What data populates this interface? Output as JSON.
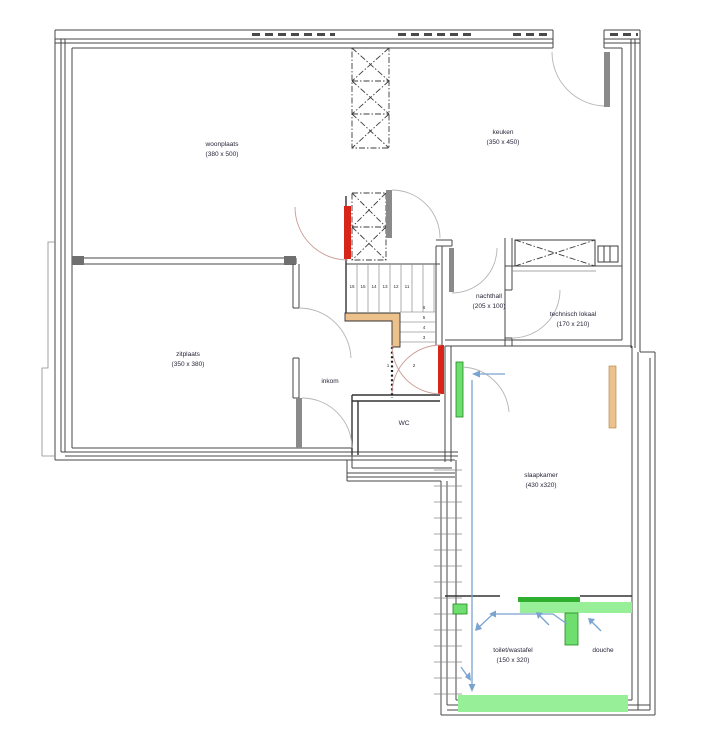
{
  "plan": {
    "title": "floor plan",
    "rooms": {
      "woonplaats": {
        "name": "woonplaats",
        "dim": "(380 x 500)"
      },
      "keuken": {
        "name": "keuken",
        "dim": "(350 x 450)"
      },
      "zitplaats": {
        "name": "zitplaats",
        "dim": "(350 x 380)"
      },
      "inkom": {
        "name": "inkom",
        "dim": ""
      },
      "nachthall": {
        "name": "nachthall",
        "dim": "(205 x 100)"
      },
      "technisch_lokaal": {
        "name": "technisch lokaal",
        "dim": "(170 x 210)"
      },
      "wc": {
        "name": "WC",
        "dim": ""
      },
      "slaapkamer": {
        "name": "slaapkamer",
        "dim": "(430 x320)"
      },
      "toilet_wastafel": {
        "name": "toilet/wastafel",
        "dim": "(150 x 320)"
      },
      "douche": {
        "name": "douche",
        "dim": ""
      }
    },
    "stairs": {
      "upper": [
        "16",
        "15",
        "14",
        "13",
        "12",
        "11"
      ],
      "lower": [
        "6",
        "5",
        "4",
        "3"
      ],
      "bottom": [
        "2",
        "1"
      ]
    },
    "colors": {
      "red": "#d8251a",
      "green": "#6ede6e",
      "green-dark": "#2fae2f",
      "green-light": "#97ef97",
      "tan": "#ecc18b",
      "blue": "#7aa4cf"
    }
  }
}
